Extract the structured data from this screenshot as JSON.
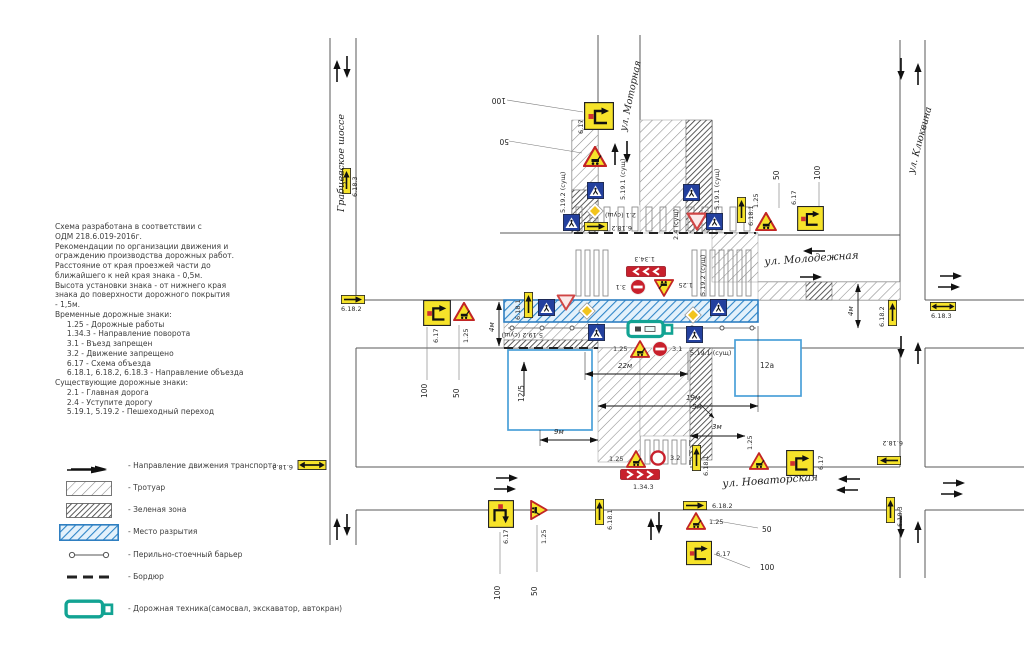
{
  "notes": {
    "lines": [
      "Схема разработана в соответствии с",
      "ОДМ 218.6.019-2016г.",
      "Рекомендации по организации движения и",
      "ограждению производства дорожных работ.",
      "Расстояние от края проезжей части до",
      "ближайшего к ней края знака - 0,5м.",
      "Высота установки знака - от нижнего края",
      "знака до поверхности дорожного покрытия",
      "- 1,5м.",
      "Временные дорожные знаки:",
      "     1.25 - Дорожные работы",
      "     1.34.3 - Направление поворота",
      "     3.1 - Въезд запрещен",
      "     3.2 - Движение запрещено",
      "     6.17 - Схема объезда",
      "     6.18.1, 6.18.2, 6.18.3 - Направление объезда",
      "Существующие дорожные знаки:",
      "     2.1 - Главная дорога",
      "     2.4 - Уступите дорогу",
      "     5.19.1, 5.19.2 - Пешеходный переход"
    ]
  },
  "legend": {
    "items": [
      {
        "symbol": "traffic-direction-arrows",
        "label": "- Направление движения транспорта"
      },
      {
        "symbol": "sidewalk-hatch",
        "label": "- Тротуар"
      },
      {
        "symbol": "green-zone-hatch",
        "label": "- Зеленая зона"
      },
      {
        "symbol": "excavation-area",
        "label": "- Место разрытия"
      },
      {
        "symbol": "post-rail-barrier",
        "label": "- Перильно-стоечный барьер"
      },
      {
        "symbol": "kerb",
        "label": "- Бордюр"
      },
      {
        "symbol": "road-machine",
        "label": "- Дорожная техника(самосвал, экскаватор, автокран)"
      }
    ]
  },
  "streets": {
    "grabtsevskoe": "Грабцевское шоссе",
    "motornaya": "ул. Моторная",
    "klyukvina": "ул. Клюквина",
    "molodezhnaya": "ул. Молодежная",
    "novatorskaya": "ул. Новаторская"
  },
  "labels": {
    "d100": "100",
    "d50": "50",
    "dim22": "22м",
    "dim19": "19м",
    "dim9": "9м",
    "dim5": "5м",
    "dim4": "4м",
    "dim3": "3м",
    "b125": "12/5",
    "b12a": "12а",
    "s6183": "6.18.3",
    "s6182": "6.18.2",
    "s6181": "6.18.1",
    "s617": "6.17",
    "s125": "1.25",
    "s31": "3.1",
    "s32": "3.2",
    "s1343": "1.34.3",
    "s21": "2.1 (сущ)",
    "s24": "2.4 (сущ)",
    "s5191": "5.19.1 (сущ)",
    "s5192": "5.19.2 (сущ)"
  }
}
